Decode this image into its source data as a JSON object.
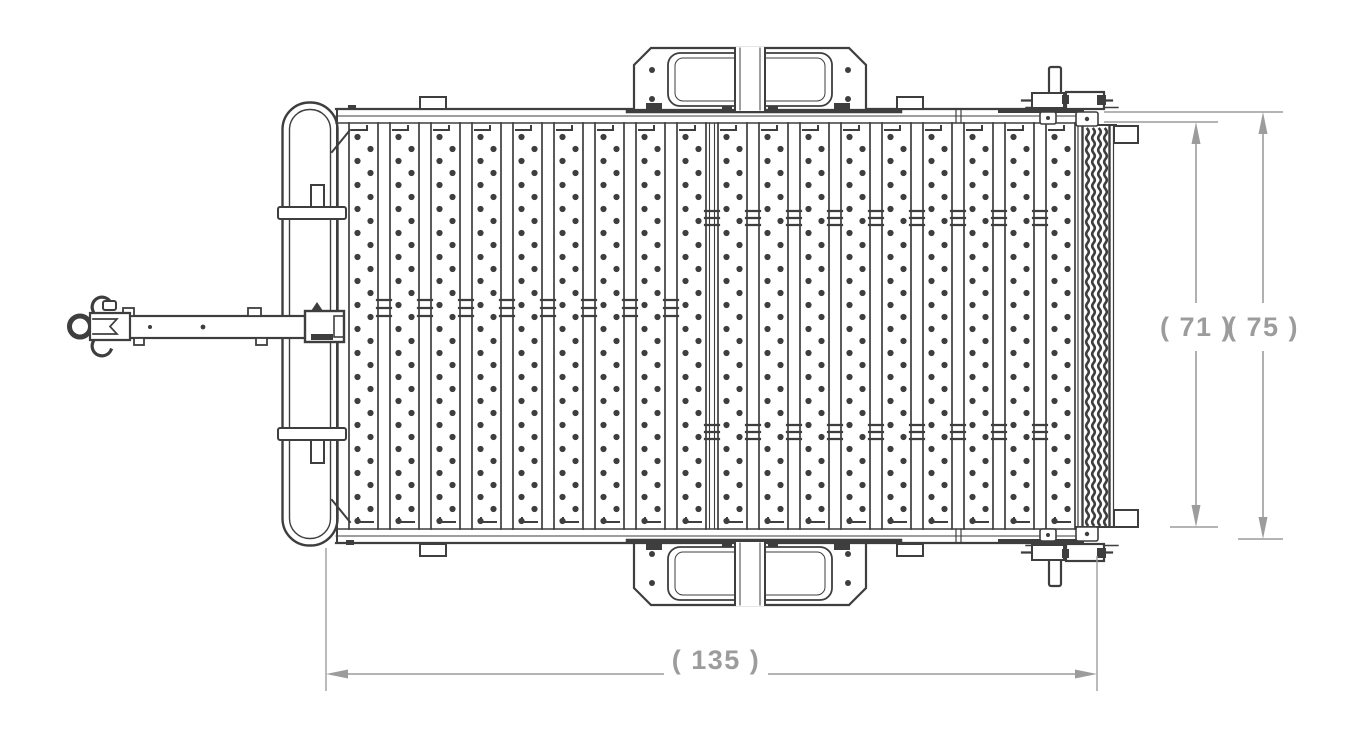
{
  "drawing": {
    "subject": "utility-trailer-top-view-line-drawing",
    "colors": {
      "line": "#3e3e3e",
      "dimension": "#9c9c9c",
      "background": "#ffffff"
    },
    "dimensions": {
      "overall_length": {
        "label": "( 135 )",
        "value": 135,
        "orientation": "horizontal"
      },
      "inner_width": {
        "label": "( 71 )",
        "value": 71,
        "orientation": "vertical"
      },
      "overall_width": {
        "label": "( 75 )",
        "value": 75,
        "orientation": "vertical"
      }
    },
    "components": [
      "coupler",
      "tongue-beam",
      "front-rail-hoop",
      "trailer-frame",
      "deck-planks",
      "fender-top",
      "fender-bottom",
      "ramp-gate",
      "rear-latch-top",
      "rear-latch-bottom",
      "hinge-brackets"
    ]
  }
}
